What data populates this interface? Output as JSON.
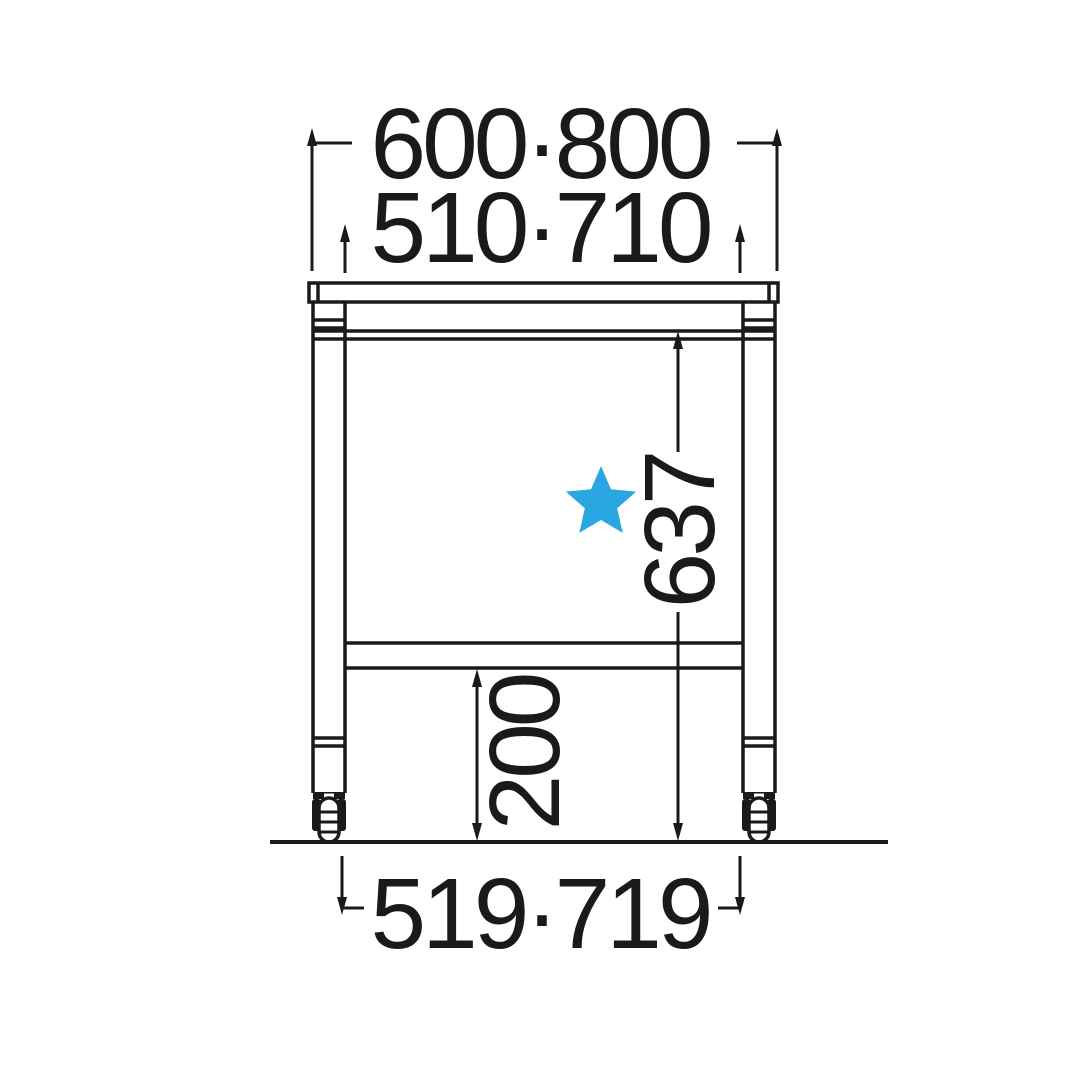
{
  "diagram": {
    "type": "technical-dimension-drawing",
    "subject": "work table with casters and under-shelf, front elevation",
    "labels": {
      "width_top_outer": "600·800",
      "width_top_inner": "510·710",
      "height_upper": "637",
      "height_lower": "200",
      "width_bottom": "519·719"
    },
    "icons": {
      "star": "filled-five-point-star"
    },
    "colors": {
      "line": "#1a1a1a",
      "star": "#2AA7E2",
      "background": "#ffffff"
    }
  }
}
